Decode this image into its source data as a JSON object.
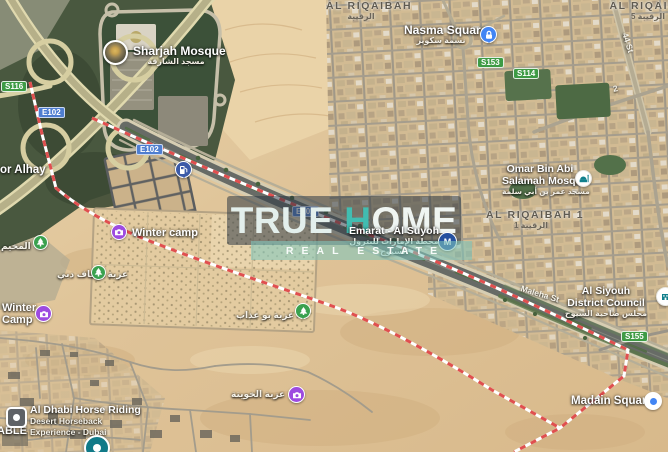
{
  "watermark": {
    "brand_part1": "TRUE ",
    "brand_accent": "H",
    "brand_part2": "OME",
    "tagline": "REAL ESTATE"
  },
  "areas": {
    "al_riqaibah": {
      "name": "AL RIQAIBAH",
      "arabic": "الرقيبة"
    },
    "al_riqaibah_5": {
      "name": "AL RIQAIBA",
      "line2": "5 الرقيبة"
    },
    "al_riqaibah_1": {
      "name": "AL RIQAIBAH 1",
      "arabic": "الرقيبة 1"
    }
  },
  "places": {
    "sharjah_mosque": {
      "name": "Sharjah Mosque",
      "arabic": "مسجد الشارقة"
    },
    "nasma_square": {
      "name": "Nasma Square",
      "arabic": "نسمة سكوير"
    },
    "omar_mosque": {
      "line1": "Omar Bin Abi",
      "line2": "Salamah Mosque",
      "arabic": "مسجد عمر بن أبي سلمة"
    },
    "emarat": {
      "name": "Emarat - Al Suyoh",
      "arabic1": "محطة الإمارات للبترول",
      "arabic2": "السيوح"
    },
    "al_siyouh_council": {
      "line1": "Al Siyouh",
      "line2": "District Council",
      "arabic": "مجلس ضاحية السيوح"
    },
    "madain_square": {
      "name": "Madain Square"
    },
    "winter_camp": {
      "name": "Winter camp"
    },
    "winter_camp_2": {
      "line1": "Winter",
      "line2": "Camp"
    },
    "or_alhay": {
      "name": "or Alhay"
    },
    "horse_riding": {
      "name": "Al Dhabi Horse Riding",
      "sub1": "Desert Horseback",
      "sub2": "Experience - Dubai"
    },
    "able": {
      "name": "ABLE"
    },
    "camp_ar": {
      "name": "المخيم"
    },
    "ezbat_awqaf": {
      "name": "عزبة أوقاف دبي"
    },
    "ezbat_bu": {
      "name": "عزبة بو عذاب"
    },
    "ezbat_khuwaitah": {
      "name": "عزبة الخويتة"
    }
  },
  "roads": {
    "shields": {
      "e102": "E102",
      "s116": "S116",
      "s153": "S153",
      "s114": "S114",
      "s155": "S155"
    },
    "streets": {
      "maleha": "Maleha St",
      "st44": "44 St",
      "st2": "2"
    }
  },
  "icons": {
    "photo_thumbnail": "camera-photo-circle",
    "nasma_square": "lock-icon",
    "omar_mosque": "mosque-icon",
    "gas_station": "fuel-pump-icon",
    "photo_spot": "camera-icon",
    "park": "tree-icon",
    "horse_riding": "stable-icon",
    "madain_square": "blue-dot-marker",
    "district_council": "building-icon",
    "emarat_station": "fuel-brand-icon"
  },
  "colors": {
    "route_shield_green": "#3e9b45",
    "route_shield_blue": "#4f7ed0",
    "poi_purple": "#9d4be0",
    "poi_green": "#3aa14f",
    "marker_blue": "#4285f4",
    "brand_teal": "#41bdb1",
    "boundary_red": "#e04f4f"
  }
}
